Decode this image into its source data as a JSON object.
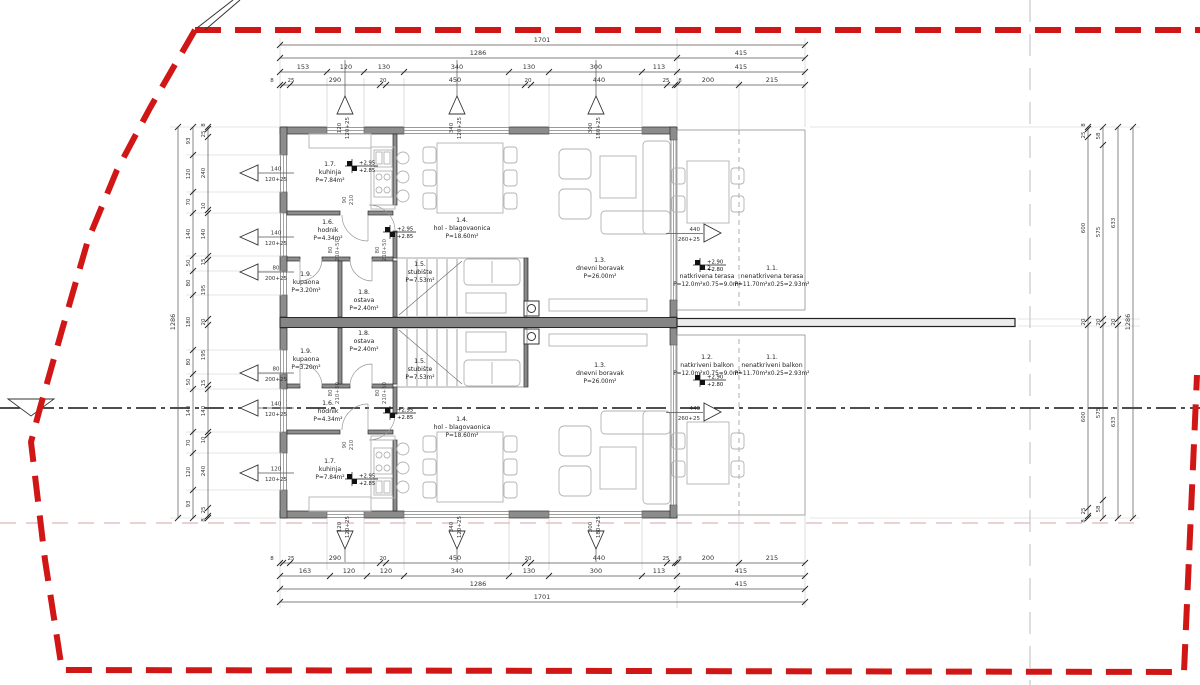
{
  "colors": {
    "boundary_red": "#d11616",
    "section_black": "#141414",
    "setback_pink": "#dfb6b6",
    "grid_gray": "#cccccc"
  },
  "rooms": {
    "t": [
      {
        "id": "1.1.",
        "name": "nenatkrivena terasa",
        "area": "P=11.70m²x0.25=2.93m²"
      },
      {
        "id": "1.2.",
        "name": "natkrivena terasa",
        "area": "P=12.0m²x0.75=9.0m²"
      },
      {
        "id": "1.3.",
        "name": "dnevni boravak",
        "area": "P=26.00m²"
      },
      {
        "id": "1.4.",
        "name": "hol - blagovaonica",
        "area": "P=18.60m²"
      },
      {
        "id": "1.5.",
        "name": "stubište",
        "area": "P=7.53m²"
      },
      {
        "id": "1.6.",
        "name": "hodnik",
        "area": "P=4.34m²"
      },
      {
        "id": "1.7.",
        "name": "kuhinja",
        "area": "P=7.84m²"
      },
      {
        "id": "1.8.",
        "name": "ostava",
        "area": "P=2.40m²"
      },
      {
        "id": "1.9.",
        "name": "kupaona",
        "area": "P=3.20m²"
      }
    ],
    "b": [
      {
        "id": "1.1.",
        "name": "nenatkriveni balkon",
        "area": "P=11.70m²x0.25=2.93m²"
      },
      {
        "id": "1.2.",
        "name": "natkriveni balkon",
        "area": "P=12.0m²x0.75=9.0m²"
      },
      {
        "id": "1.3.",
        "name": "dnevni boravak",
        "area": "P=26.00m²"
      },
      {
        "id": "1.4.",
        "name": "hol - blagovaonica",
        "area": "P=18.60m²"
      },
      {
        "id": "1.5.",
        "name": "stubište",
        "area": "P=7.53m²"
      },
      {
        "id": "1.6.",
        "name": "hodnik",
        "area": "P=4.34m²"
      },
      {
        "id": "1.7.",
        "name": "kuhinja",
        "area": "P=7.84m²"
      },
      {
        "id": "1.8.",
        "name": "ostava",
        "area": "P=2.40m²"
      },
      {
        "id": "1.9.",
        "name": "kupaona",
        "area": "P=3.20m²"
      }
    ]
  },
  "dim": {
    "t1": "1701",
    "t2": "1286",
    "t2b": "415",
    "t3": [
      "153",
      "120",
      "130",
      "340",
      "130",
      "300",
      "113"
    ],
    "t3b": "415",
    "t4": [
      "8",
      "25",
      "290",
      "20",
      "450",
      "20",
      "440",
      "25",
      "8"
    ],
    "t4b": [
      "200",
      "215"
    ],
    "b1": "1701",
    "b2": "1286",
    "b2b": "415",
    "b3": [
      "163",
      "120",
      "120",
      "340",
      "130",
      "300",
      "113"
    ],
    "b3b": "415",
    "b4": [
      "8",
      "25",
      "290",
      "20",
      "450",
      "20",
      "440",
      "25",
      "8"
    ],
    "b4b": [
      "200",
      "215"
    ],
    "l1": "1286",
    "l2": [
      "93",
      "120",
      "70",
      "140",
      "50",
      "80",
      "180",
      "80",
      "50",
      "140",
      "70",
      "120",
      "93"
    ],
    "l3": [
      "8",
      "25",
      "240",
      "10",
      "140",
      "15",
      "195",
      "20",
      "195",
      "15",
      "140",
      "10",
      "240",
      "25",
      "8"
    ],
    "r1": [
      "8",
      "25",
      "600",
      "20",
      "600",
      "25",
      "8"
    ],
    "r2": [
      "58",
      "575",
      "20",
      "575",
      "58"
    ],
    "r3": [
      "633",
      "20",
      "633"
    ],
    "r4": "1286"
  },
  "win": {
    "left": [
      {
        "w": "140",
        "h": "120+25"
      },
      {
        "w": "140",
        "h": "120+25"
      },
      {
        "w": "80",
        "h": "200+25"
      },
      {
        "w": "80",
        "h": "200+25"
      },
      {
        "w": "140",
        "h": "120+25"
      },
      {
        "w": "120",
        "h": "120+25"
      }
    ],
    "top": [
      {
        "w": "120",
        "h": "120+25"
      },
      {
        "w": "340",
        "h": "120+25"
      },
      {
        "w": "300",
        "h": "180+25"
      }
    ],
    "bottom": [
      {
        "w": "120",
        "h": "120+25"
      },
      {
        "w": "340",
        "h": "120+25"
      },
      {
        "w": "300",
        "h": "180+25"
      }
    ],
    "right": [
      {
        "w": "440",
        "h": "260+25"
      },
      {
        "w": "440",
        "h": "260+25"
      }
    ],
    "door": {
      "w": "80",
      "h": "210+50"
    },
    "door2": {
      "w": "90",
      "h": "210"
    }
  },
  "lvl": {
    "iu": "+2.95",
    "il": "+2.85",
    "tu": "+2.90",
    "tl": "+2.80"
  }
}
